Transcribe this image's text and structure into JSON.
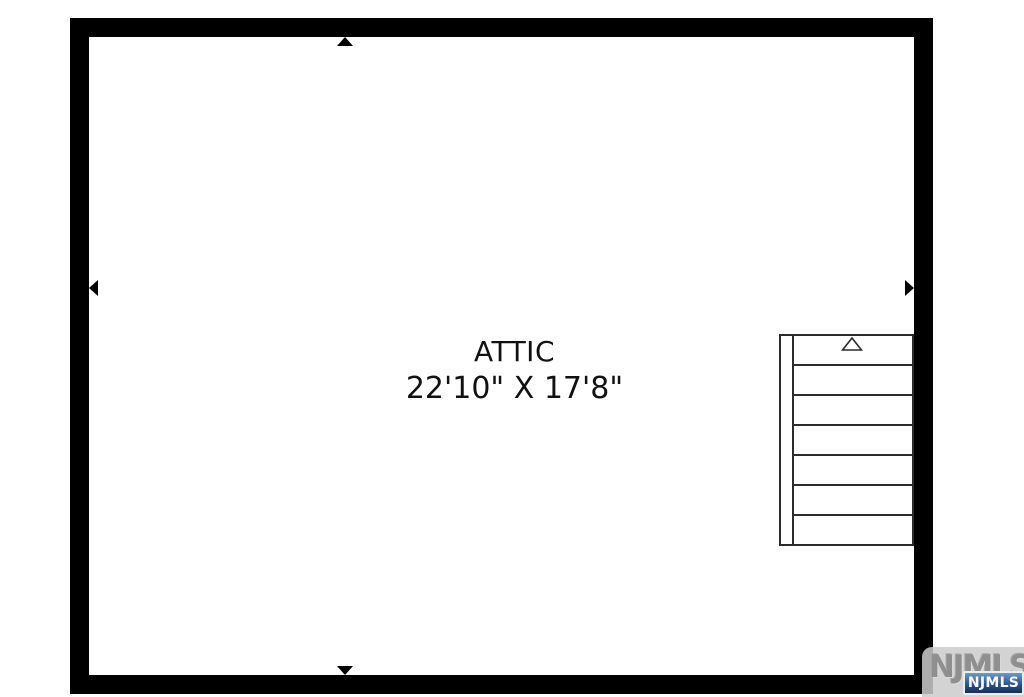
{
  "floorplan": {
    "room": {
      "name": "ATTIC",
      "dimensions": "22'10\" X 17'8\""
    },
    "stairs": {
      "tread_count": 7,
      "direction_marker": "up-triangle"
    },
    "wall_markers": [
      "top",
      "left",
      "right",
      "bottom"
    ]
  },
  "watermark": {
    "background_text": "NJMLS",
    "badge_text": "NJMLS"
  },
  "colors": {
    "wall": "#000000",
    "stair_line": "#2b2b2b",
    "text": "#111111",
    "badge_blue_dark": "#122f57",
    "badge_blue_light": "#7199cc",
    "watermark_grey": "#8f8f8f",
    "background": "#ffffff"
  }
}
